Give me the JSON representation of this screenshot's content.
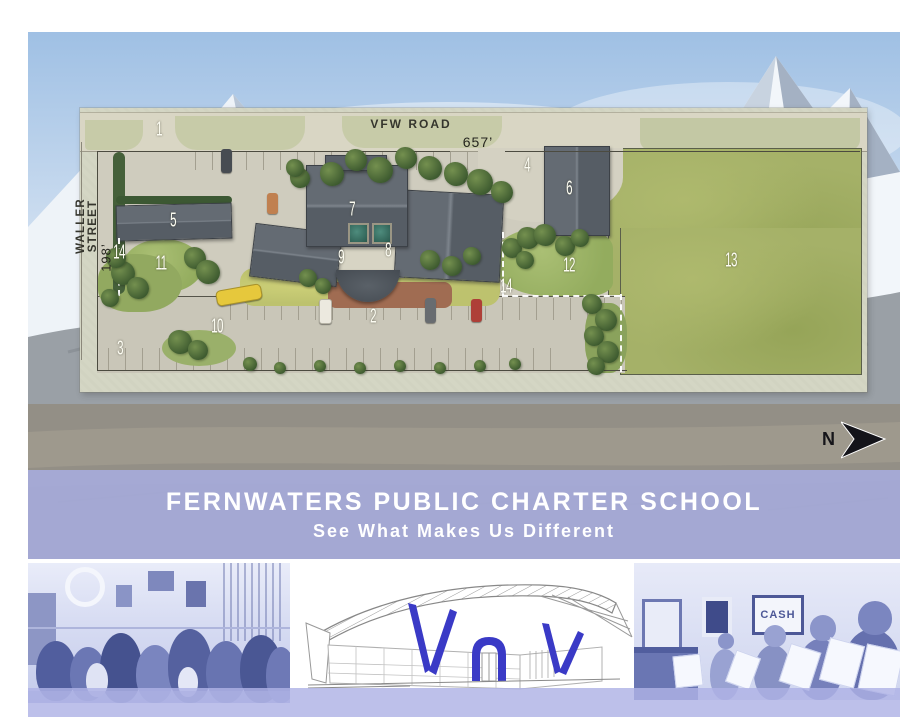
{
  "banner": {
    "title": "FERNWATERS PUBLIC CHARTER SCHOOL",
    "subtitle": "See What Makes Us Different",
    "background_color": "#a8addf",
    "text_color": "#ffffff"
  },
  "site_plan": {
    "road_top_label": "VFW ROAD",
    "road_left_label": "WALLER STREET",
    "dimension_top": "657’",
    "dimension_left": "198’",
    "north_label": "N",
    "markers": [
      {
        "id": "1",
        "x": 159,
        "y": 130
      },
      {
        "id": "2",
        "x": 373,
        "y": 317
      },
      {
        "id": "3",
        "x": 120,
        "y": 349
      },
      {
        "id": "4",
        "x": 527,
        "y": 166
      },
      {
        "id": "5",
        "x": 173,
        "y": 221
      },
      {
        "id": "6",
        "x": 569,
        "y": 189
      },
      {
        "id": "7",
        "x": 352,
        "y": 210
      },
      {
        "id": "8",
        "x": 388,
        "y": 251
      },
      {
        "id": "9",
        "x": 341,
        "y": 258
      },
      {
        "id": "10",
        "x": 217,
        "y": 327
      },
      {
        "id": "11",
        "x": 161,
        "y": 264
      },
      {
        "id": "12",
        "x": 569,
        "y": 266
      },
      {
        "id": "13",
        "x": 731,
        "y": 261
      },
      {
        "id": "14",
        "x": 119,
        "y": 253
      },
      {
        "id": "14",
        "x": 506,
        "y": 287
      }
    ]
  },
  "photos": {
    "right": {
      "poster_text": "CASH"
    }
  },
  "colors": {
    "banner_purple": "#a8addf",
    "sketch_blue": "#3a3ac6",
    "field_green": "#a5b168",
    "roof_gray": "#596068"
  }
}
